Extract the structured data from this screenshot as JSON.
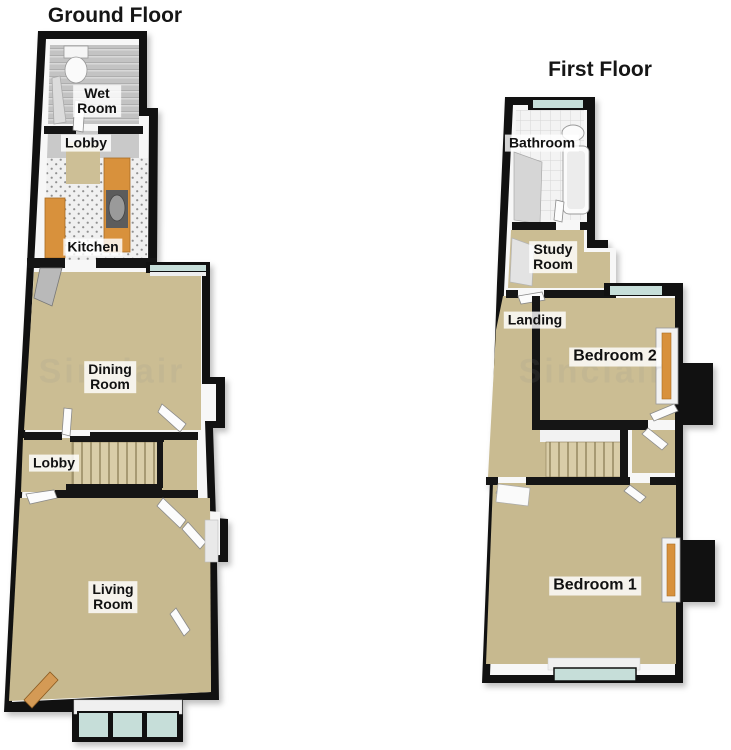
{
  "colors": {
    "wall": "#111111",
    "wall_face": "#f7f7f7",
    "carpet": "#cbbd93",
    "carpet_dark": "#c7b98f",
    "hall_floor": "#c9bb91",
    "gray_floor": "#c9c9c9",
    "window_glass": "#c6ded9",
    "wood": "#d8913c",
    "stairs": "#d9cda8",
    "label_bg": "rgba(255,255,255,0.82)",
    "label_text": "#111111"
  },
  "floors": [
    {
      "id": "ground-floor",
      "title": "Ground Floor",
      "rooms": [
        {
          "name": "wet-room",
          "label": "Wet\nRoom"
        },
        {
          "name": "lobby",
          "label": "Lobby"
        },
        {
          "name": "kitchen",
          "label": "Kitchen"
        },
        {
          "name": "dining-room",
          "label": "Dining\nRoom"
        },
        {
          "name": "lobby-2",
          "label": "Lobby"
        },
        {
          "name": "living-room",
          "label": "Living\nRoom"
        }
      ]
    },
    {
      "id": "first-floor",
      "title": "First Floor",
      "rooms": [
        {
          "name": "bathroom",
          "label": "Bathroom"
        },
        {
          "name": "study-room",
          "label": "Study\nRoom"
        },
        {
          "name": "landing",
          "label": "Landing"
        },
        {
          "name": "bedroom-2",
          "label": "Bedroom 2"
        },
        {
          "name": "bedroom-1",
          "label": "Bedroom 1"
        }
      ]
    }
  ],
  "watermark": "Sinclair"
}
